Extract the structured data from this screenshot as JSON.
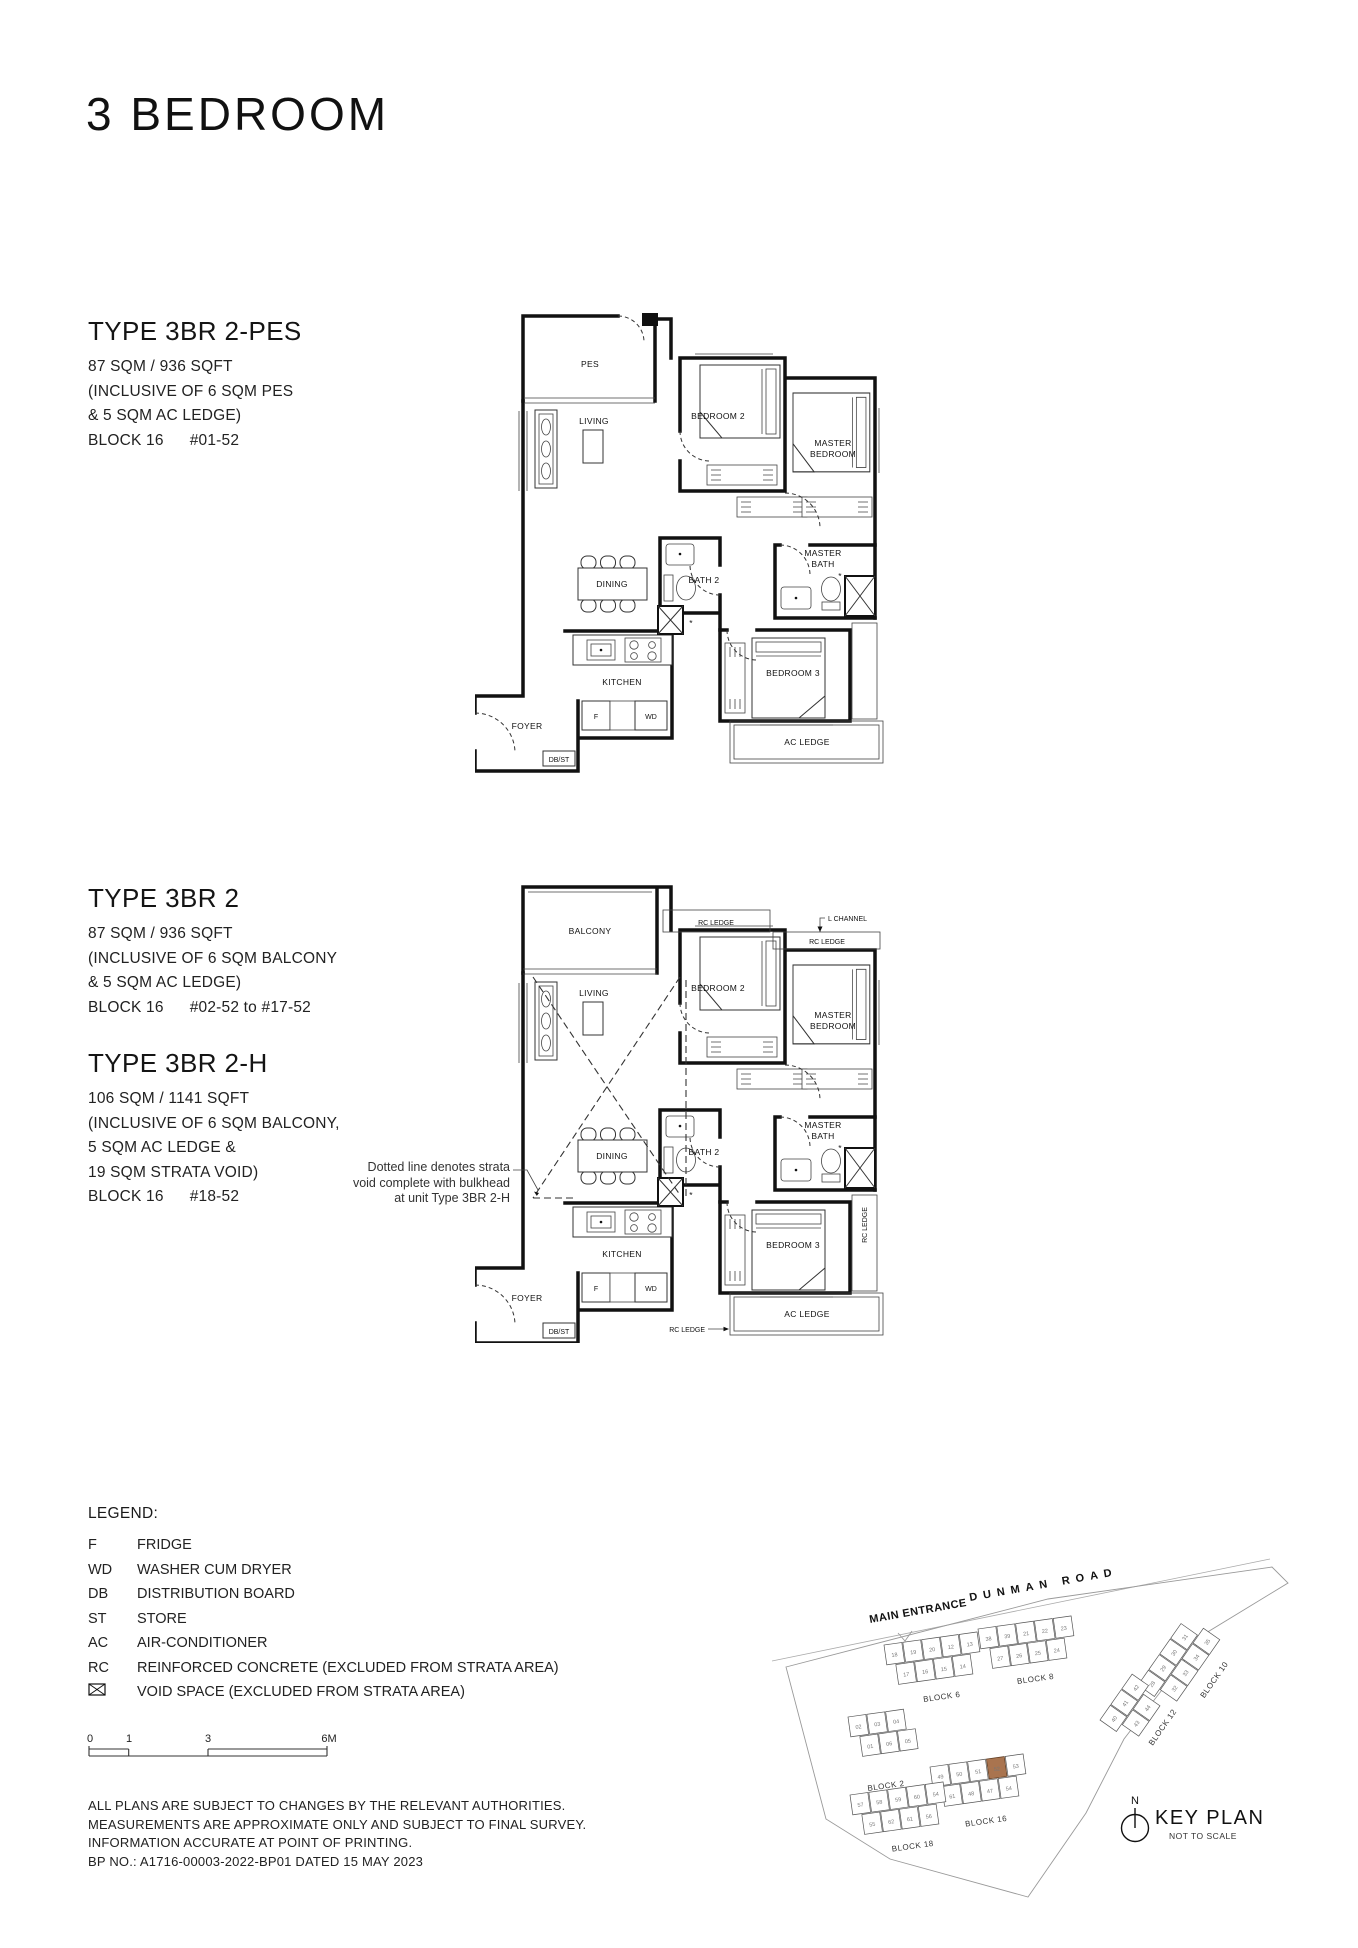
{
  "page": {
    "title": "3 BEDROOM"
  },
  "plan1": {
    "title": "TYPE 3BR 2-PES",
    "area": "87 SQM / 936 SQFT",
    "incl1": "(INCLUSIVE OF 6 SQM PES",
    "incl2": "& 5 SQM AC LEDGE)",
    "block": "BLOCK 16",
    "units": "#01-52",
    "rooms": {
      "pes": "PES",
      "living": "LIVING",
      "bedroom2": "BEDROOM 2",
      "master1": "MASTER",
      "master2": "BEDROOM",
      "mbath1": "MASTER",
      "mbath2": "BATH",
      "dining": "DINING",
      "bath2": "BATH 2",
      "kitchen": "KITCHEN",
      "foyer": "FOYER",
      "bedroom3": "BEDROOM 3",
      "acledge": "AC LEDGE",
      "f": "F",
      "wd": "WD",
      "dbst": "DB/ST",
      "star": "*"
    }
  },
  "plan2": {
    "t2": {
      "title": "TYPE 3BR 2",
      "area": "87 SQM / 936 SQFT",
      "incl1": "(INCLUSIVE OF 6 SQM BALCONY",
      "incl2": "& 5 SQM AC LEDGE)",
      "block": "BLOCK 16",
      "units": "#02-52 to #17-52"
    },
    "t2h": {
      "title": "TYPE 3BR 2-H",
      "area": "106 SQM / 1141 SQFT",
      "incl1": "(INCLUSIVE OF 6 SQM BALCONY,",
      "incl2": "5 SQM AC LEDGE &",
      "incl3": "19 SQM STRATA VOID)",
      "block": "BLOCK 16",
      "units": "#18-52"
    },
    "note1": "Dotted line denotes strata",
    "note2": "void complete with bulkhead",
    "note3": "at unit Type 3BR 2-H",
    "rooms": {
      "balcony": "BALCONY",
      "rcledge_top": "RC LEDGE",
      "rcledge_top2": "RC LEDGE",
      "lchannel": "L CHANNEL",
      "living": "LIVING",
      "bedroom2": "BEDROOM 2",
      "master1": "MASTER",
      "master2": "BEDROOM",
      "mbath1": "MASTER",
      "mbath2": "BATH",
      "dining": "DINING",
      "bath2": "BATH 2",
      "kitchen": "KITCHEN",
      "foyer": "FOYER",
      "bedroom3": "BEDROOM 3",
      "rcledge_right": "RC LEDGE",
      "acledge": "AC LEDGE",
      "rcledge_bottom": "RC LEDGE",
      "f": "F",
      "wd": "WD",
      "dbst": "DB/ST",
      "star": "*"
    }
  },
  "legend": {
    "title": "LEGEND:",
    "items": [
      {
        "abbr": "F",
        "label": "FRIDGE"
      },
      {
        "abbr": "WD",
        "label": "WASHER CUM DRYER"
      },
      {
        "abbr": "DB",
        "label": "DISTRIBUTION BOARD"
      },
      {
        "abbr": "ST",
        "label": "STORE"
      },
      {
        "abbr": "AC",
        "label": "AIR-CONDITIONER"
      },
      {
        "abbr": "RC",
        "label": "REINFORCED CONCRETE (EXCLUDED FROM STRATA AREA)"
      },
      {
        "abbr": "",
        "label": "VOID SPACE (EXCLUDED FROM STRATA AREA)"
      }
    ]
  },
  "scalebar": {
    "m0": "0",
    "m1": "1",
    "m3": "3",
    "m6": "6M"
  },
  "disclaimer": {
    "l1": "ALL PLANS ARE SUBJECT TO CHANGES BY THE RELEVANT AUTHORITIES.",
    "l2": "MEASUREMENTS ARE APPROXIMATE ONLY AND SUBJECT TO FINAL SURVEY.",
    "l3": "INFORMATION ACCURATE AT POINT OF PRINTING.",
    "l4": "BP NO.: A1716-00003-2022-BP01 DATED 15 MAY 2023"
  },
  "keyplan": {
    "entrance": "MAIN ENTRANCE",
    "road": "DUNMAN ROAD",
    "north": "N",
    "title": "KEY PLAN",
    "subtitle": "NOT TO SCALE",
    "highlight_unit": "52",
    "highlight_color": "#a9744f",
    "clusters": [
      {
        "id": "block6",
        "label": "BLOCK 6",
        "units": [
          "18",
          "19",
          "20",
          "12",
          "13",
          "17",
          "16",
          "15",
          "14"
        ]
      },
      {
        "id": "block8",
        "label": "BLOCK 8",
        "units": [
          "38",
          "39",
          "21",
          "22",
          "23",
          "27",
          "26",
          "25",
          "24"
        ]
      },
      {
        "id": "block10",
        "label": "BLOCK 10",
        "units": [
          "28",
          "29",
          "30",
          "31",
          "32",
          "33",
          "34",
          "35"
        ]
      },
      {
        "id": "block12",
        "label": "BLOCK 12",
        "units": [
          "40",
          "41",
          "42",
          "43",
          "44"
        ]
      },
      {
        "id": "block2",
        "label": "BLOCK 2",
        "units": [
          "02",
          "03",
          "04",
          "01",
          "06",
          "05"
        ]
      },
      {
        "id": "block16",
        "label": "BLOCK 16",
        "units": [
          "49",
          "50",
          "51",
          "52",
          "53",
          "61",
          "48",
          "47",
          "54"
        ]
      },
      {
        "id": "block18",
        "label": "BLOCK 18",
        "units": [
          "57",
          "58",
          "59",
          "60",
          "54",
          "55",
          "62",
          "61",
          "56"
        ]
      }
    ]
  }
}
